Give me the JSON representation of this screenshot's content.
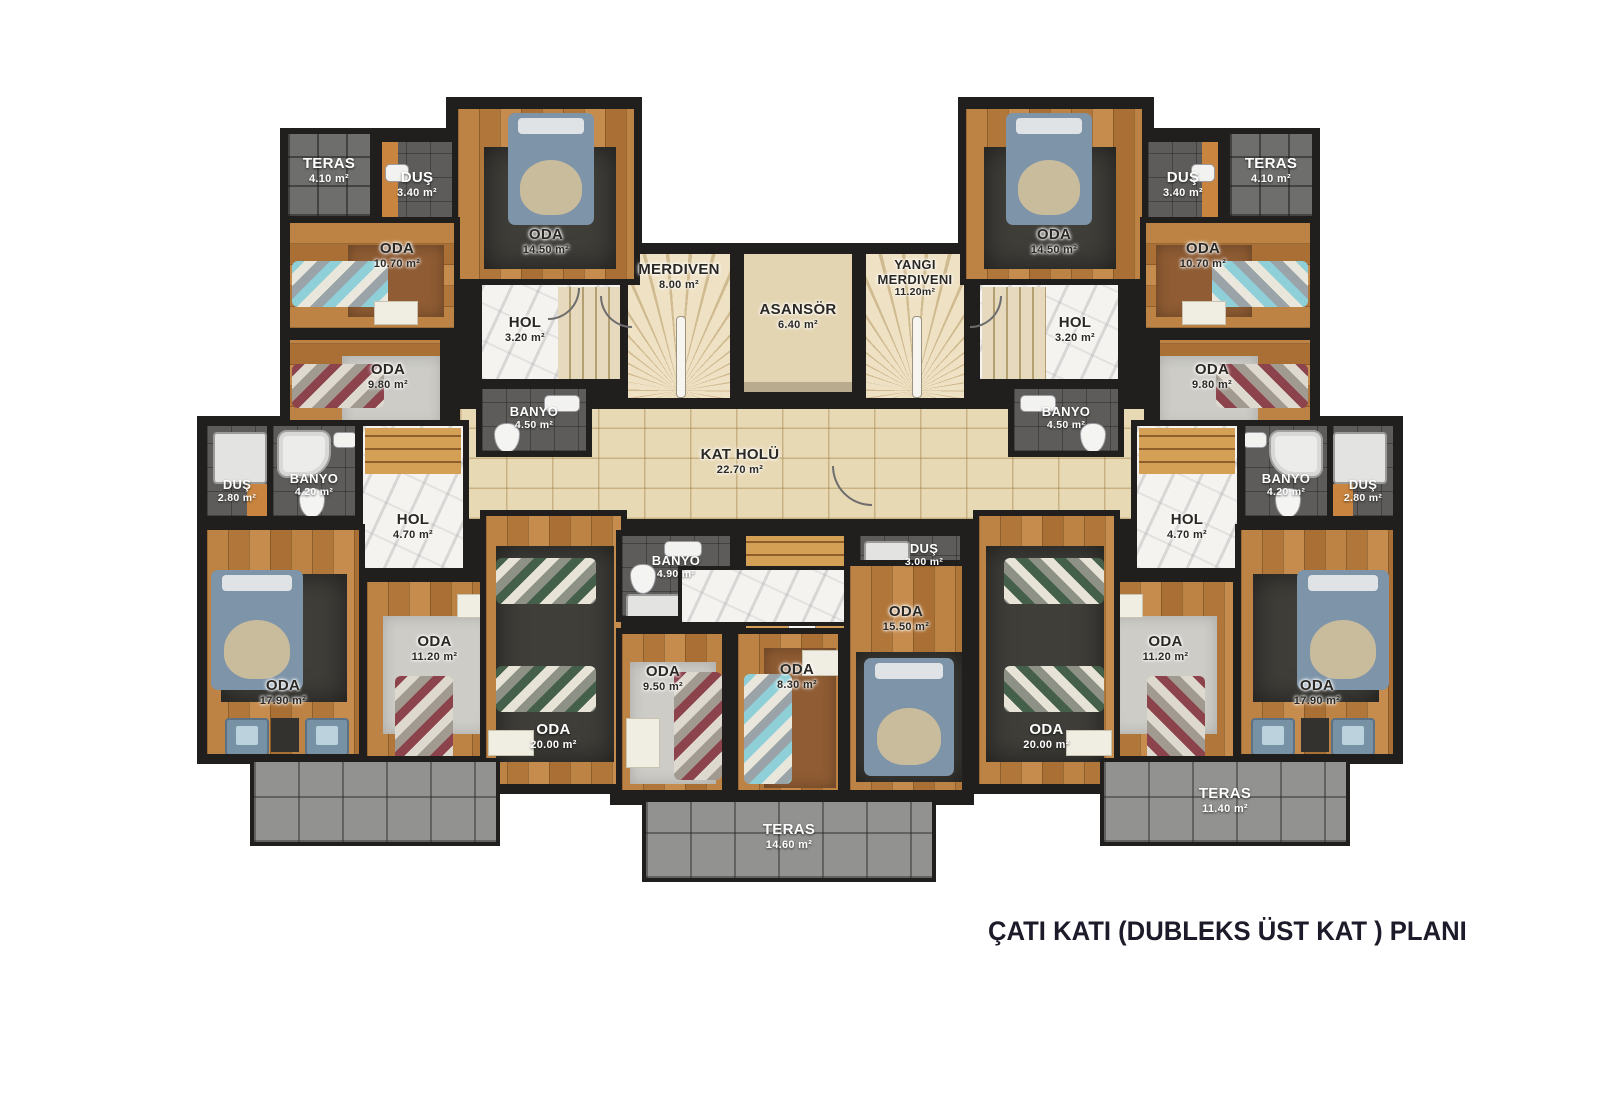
{
  "title": "ÇATI KATI (DUBLEKS ÜST KAT )  PLANI",
  "colors": {
    "wall": "#211e1e",
    "wood_floor": "#b87c40",
    "hall_stone": "#e8d9b5",
    "marble": "#f5f3ef",
    "bath_tile": "#5d5c5a",
    "terrace_tile": "#929290",
    "accent_wood": "#c9853f",
    "rug_dark": "#3f3e39",
    "bed_blue": "#7e94a9",
    "title_text": "#1d1b2a"
  },
  "rooms": {
    "teras_41_l": {
      "name": "TERAS",
      "area": "4.10 m²"
    },
    "dus_340_l": {
      "name": "DUŞ",
      "area": "3.40 m²"
    },
    "oda_1450_l": {
      "name": "ODA",
      "area": "14.50 m²"
    },
    "oda_1070_l": {
      "name": "ODA",
      "area": "10.70 m²"
    },
    "hol_320_l": {
      "name": "HOL",
      "area": "3.20 m²"
    },
    "oda_980_l": {
      "name": "ODA",
      "area": "9.80 m²"
    },
    "banyo_450_l": {
      "name": "BANYO",
      "area": "4.50 m²"
    },
    "dus_280_l": {
      "name": "DUŞ",
      "area": "2.80 m²"
    },
    "banyo_420_l": {
      "name": "BANYO",
      "area": "4.20 m²"
    },
    "hol_470_l": {
      "name": "HOL",
      "area": "4.70 m²"
    },
    "oda_1790_l": {
      "name": "ODA",
      "area": "17.90 m²"
    },
    "oda_1120_l": {
      "name": "ODA",
      "area": "11.20 m²"
    },
    "oda_2000_l": {
      "name": "ODA",
      "area": "20.00 m²"
    },
    "merdiven": {
      "name": "MERDIVEN",
      "area": "8.00 m²"
    },
    "asansor": {
      "name": "ASANSÖR",
      "area": "6.40 m²"
    },
    "yangi": {
      "name": "YANGI MERDIVENI",
      "area": "11.20m²"
    },
    "kat_holu": {
      "name": "KAT HOLÜ",
      "area": "22.70 m²"
    },
    "banyo_490": {
      "name": "BANYO",
      "area": "4.90 m²"
    },
    "dus_300": {
      "name": "DUŞ",
      "area": "3.00 m²"
    },
    "oda_950": {
      "name": "ODA",
      "area": "9.50 m²"
    },
    "oda_830": {
      "name": "ODA",
      "area": "8.30 m²"
    },
    "oda_1550": {
      "name": "ODA",
      "area": "15.50 m²"
    },
    "teras_1460": {
      "name": "TERAS",
      "area": "14.60 m²"
    },
    "teras_41_r": {
      "name": "TERAS",
      "area": "4.10 m²"
    },
    "dus_340_r": {
      "name": "DUŞ",
      "area": "3.40 m²"
    },
    "oda_1450_r": {
      "name": "ODA",
      "area": "14.50 m²"
    },
    "oda_1070_r": {
      "name": "ODA",
      "area": "10.70 m²"
    },
    "hol_320_r": {
      "name": "HOL",
      "area": "3.20 m²"
    },
    "oda_980_r": {
      "name": "ODA",
      "area": "9.80 m²"
    },
    "banyo_450_r": {
      "name": "BANYO",
      "area": "4.50 m²"
    },
    "dus_280_r": {
      "name": "DUŞ",
      "area": "2.80 m²"
    },
    "banyo_420_r": {
      "name": "BANYO",
      "area": "4.20 m²"
    },
    "hol_470_r": {
      "name": "HOL",
      "area": "4.70 m²"
    },
    "oda_1790_r": {
      "name": "ODA",
      "area": "17.90 m²"
    },
    "oda_1120_r": {
      "name": "ODA",
      "area": "11.20 m²"
    },
    "oda_2000_r": {
      "name": "ODA",
      "area": "20.00 m²"
    },
    "teras_1140": {
      "name": "TERAS",
      "area": "11.40 m²"
    }
  }
}
